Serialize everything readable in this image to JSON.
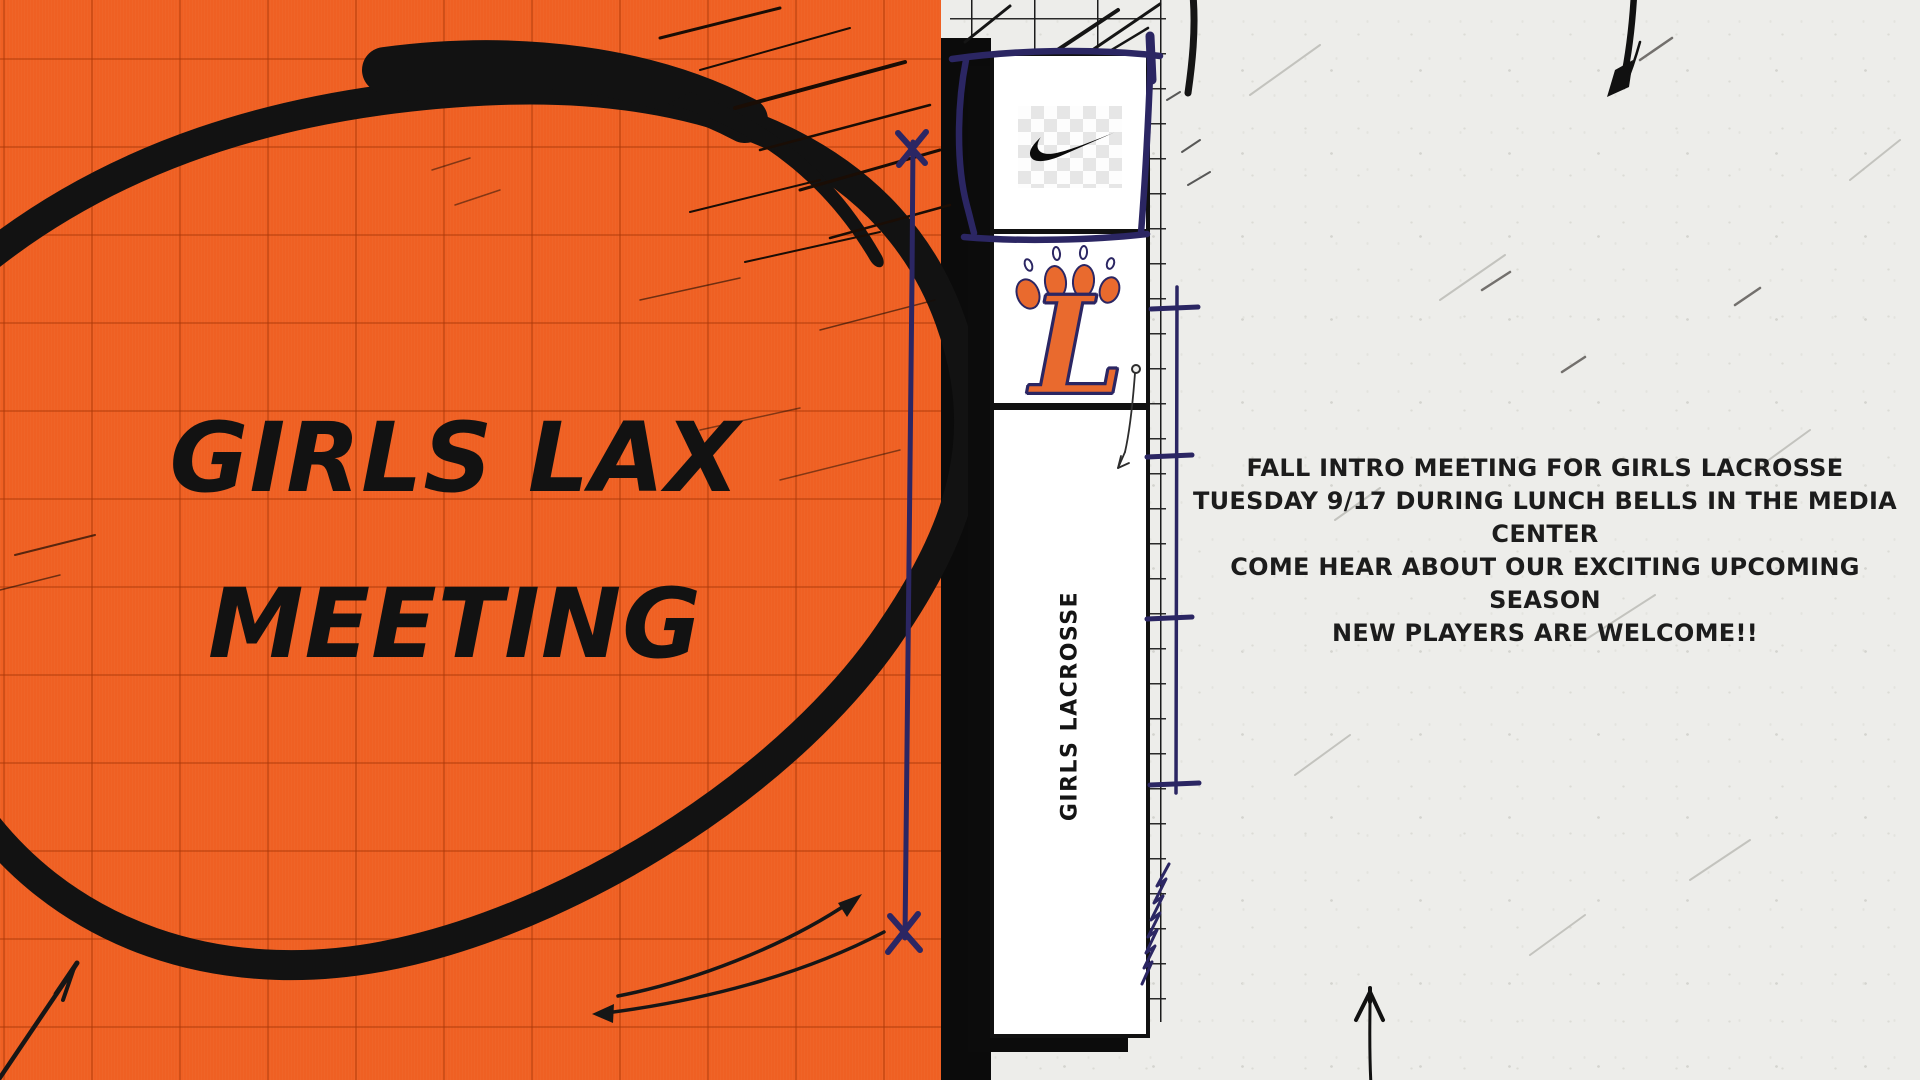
{
  "poster": {
    "left_panel": {
      "title_line1": "GIRLS LAX",
      "title_line2": "MEETING"
    },
    "banner": {
      "team_letter": "L",
      "vertical_label": "GIRLS LACROSSE"
    },
    "announcement": {
      "lines": [
        "FALL INTRO MEETING FOR GIRLS LACROSSE",
        "TUESDAY 9/17 DURING LUNCH BELLS IN THE MEDIA",
        "CENTER",
        "COME HEAR ABOUT OUR EXCITING UPCOMING SEASON",
        "NEW PLAYERS ARE WELCOME!!"
      ]
    },
    "icons": {
      "nike": "nike-swoosh",
      "paw": "paw-print-logo",
      "scribble": "marker-ellipse-scribble"
    },
    "colors": {
      "orange": "#EF6023",
      "paper": "#EDEDEA",
      "navy": "#2B2663",
      "ink": "#121212",
      "logo_orange": "#E96A2E"
    }
  }
}
